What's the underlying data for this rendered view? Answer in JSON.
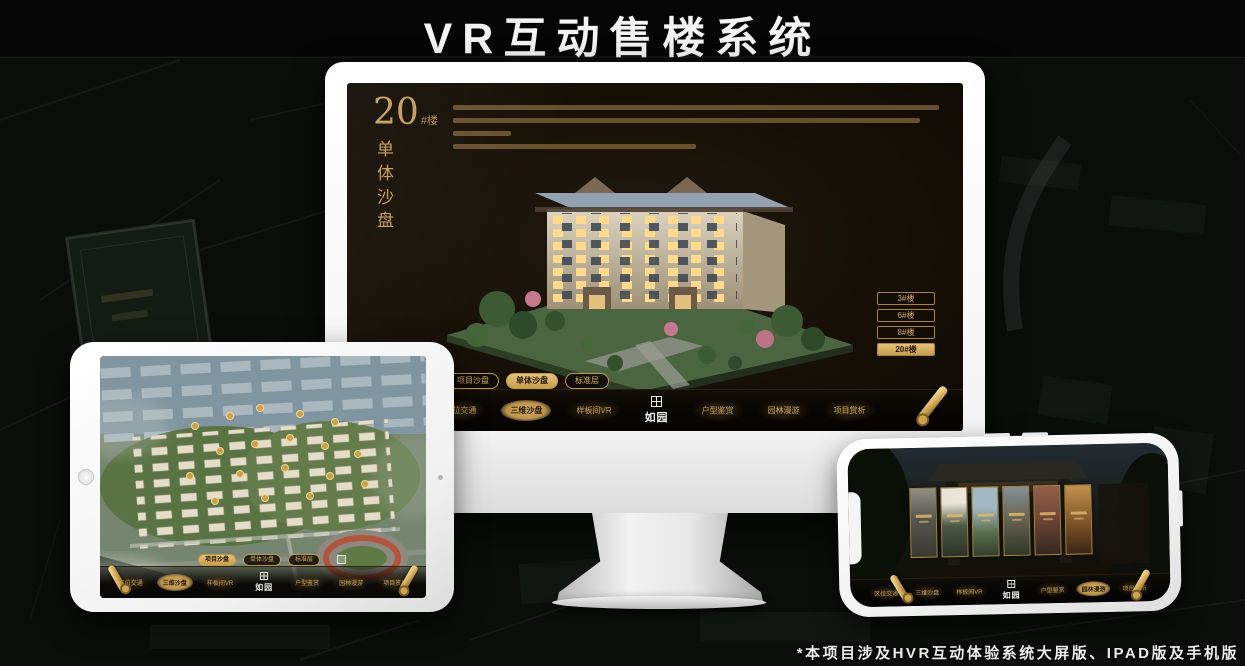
{
  "page": {
    "title": "VR互动售楼系统",
    "footnote": "*本项目涉及HVR互动体验系统大屏版、IPAD版及手机版"
  },
  "app": {
    "logo": "如园",
    "nav_items": [
      {
        "label": "区位交通"
      },
      {
        "label": "三维沙盘"
      },
      {
        "label": "样板间VR"
      },
      {
        "label": "户型鉴赏"
      },
      {
        "label": "园林漫游"
      },
      {
        "label": "项目赏析"
      }
    ]
  },
  "monitor": {
    "headline": {
      "number": "20",
      "suffix": "#楼",
      "vertical": "单体沙盘"
    },
    "tabs": [
      {
        "label": "项目沙盘",
        "active": false
      },
      {
        "label": "单体沙盘",
        "active": true
      },
      {
        "label": "标准层",
        "active": false
      }
    ],
    "building_buttons": [
      {
        "label": "3#楼",
        "active": false
      },
      {
        "label": "6#楼",
        "active": false
      },
      {
        "label": "8#楼",
        "active": false
      },
      {
        "label": "20#楼",
        "active": true
      }
    ],
    "nav_active": {
      "1": true
    }
  },
  "tablet": {
    "tabs": [
      {
        "label": "项目沙盘",
        "active": true
      },
      {
        "label": "单体沙盘",
        "active": false
      },
      {
        "label": "标准层",
        "active": false
      }
    ],
    "nav_active": {
      "1": true
    }
  },
  "phone": {
    "nav_active": {
      "4": true
    }
  }
}
